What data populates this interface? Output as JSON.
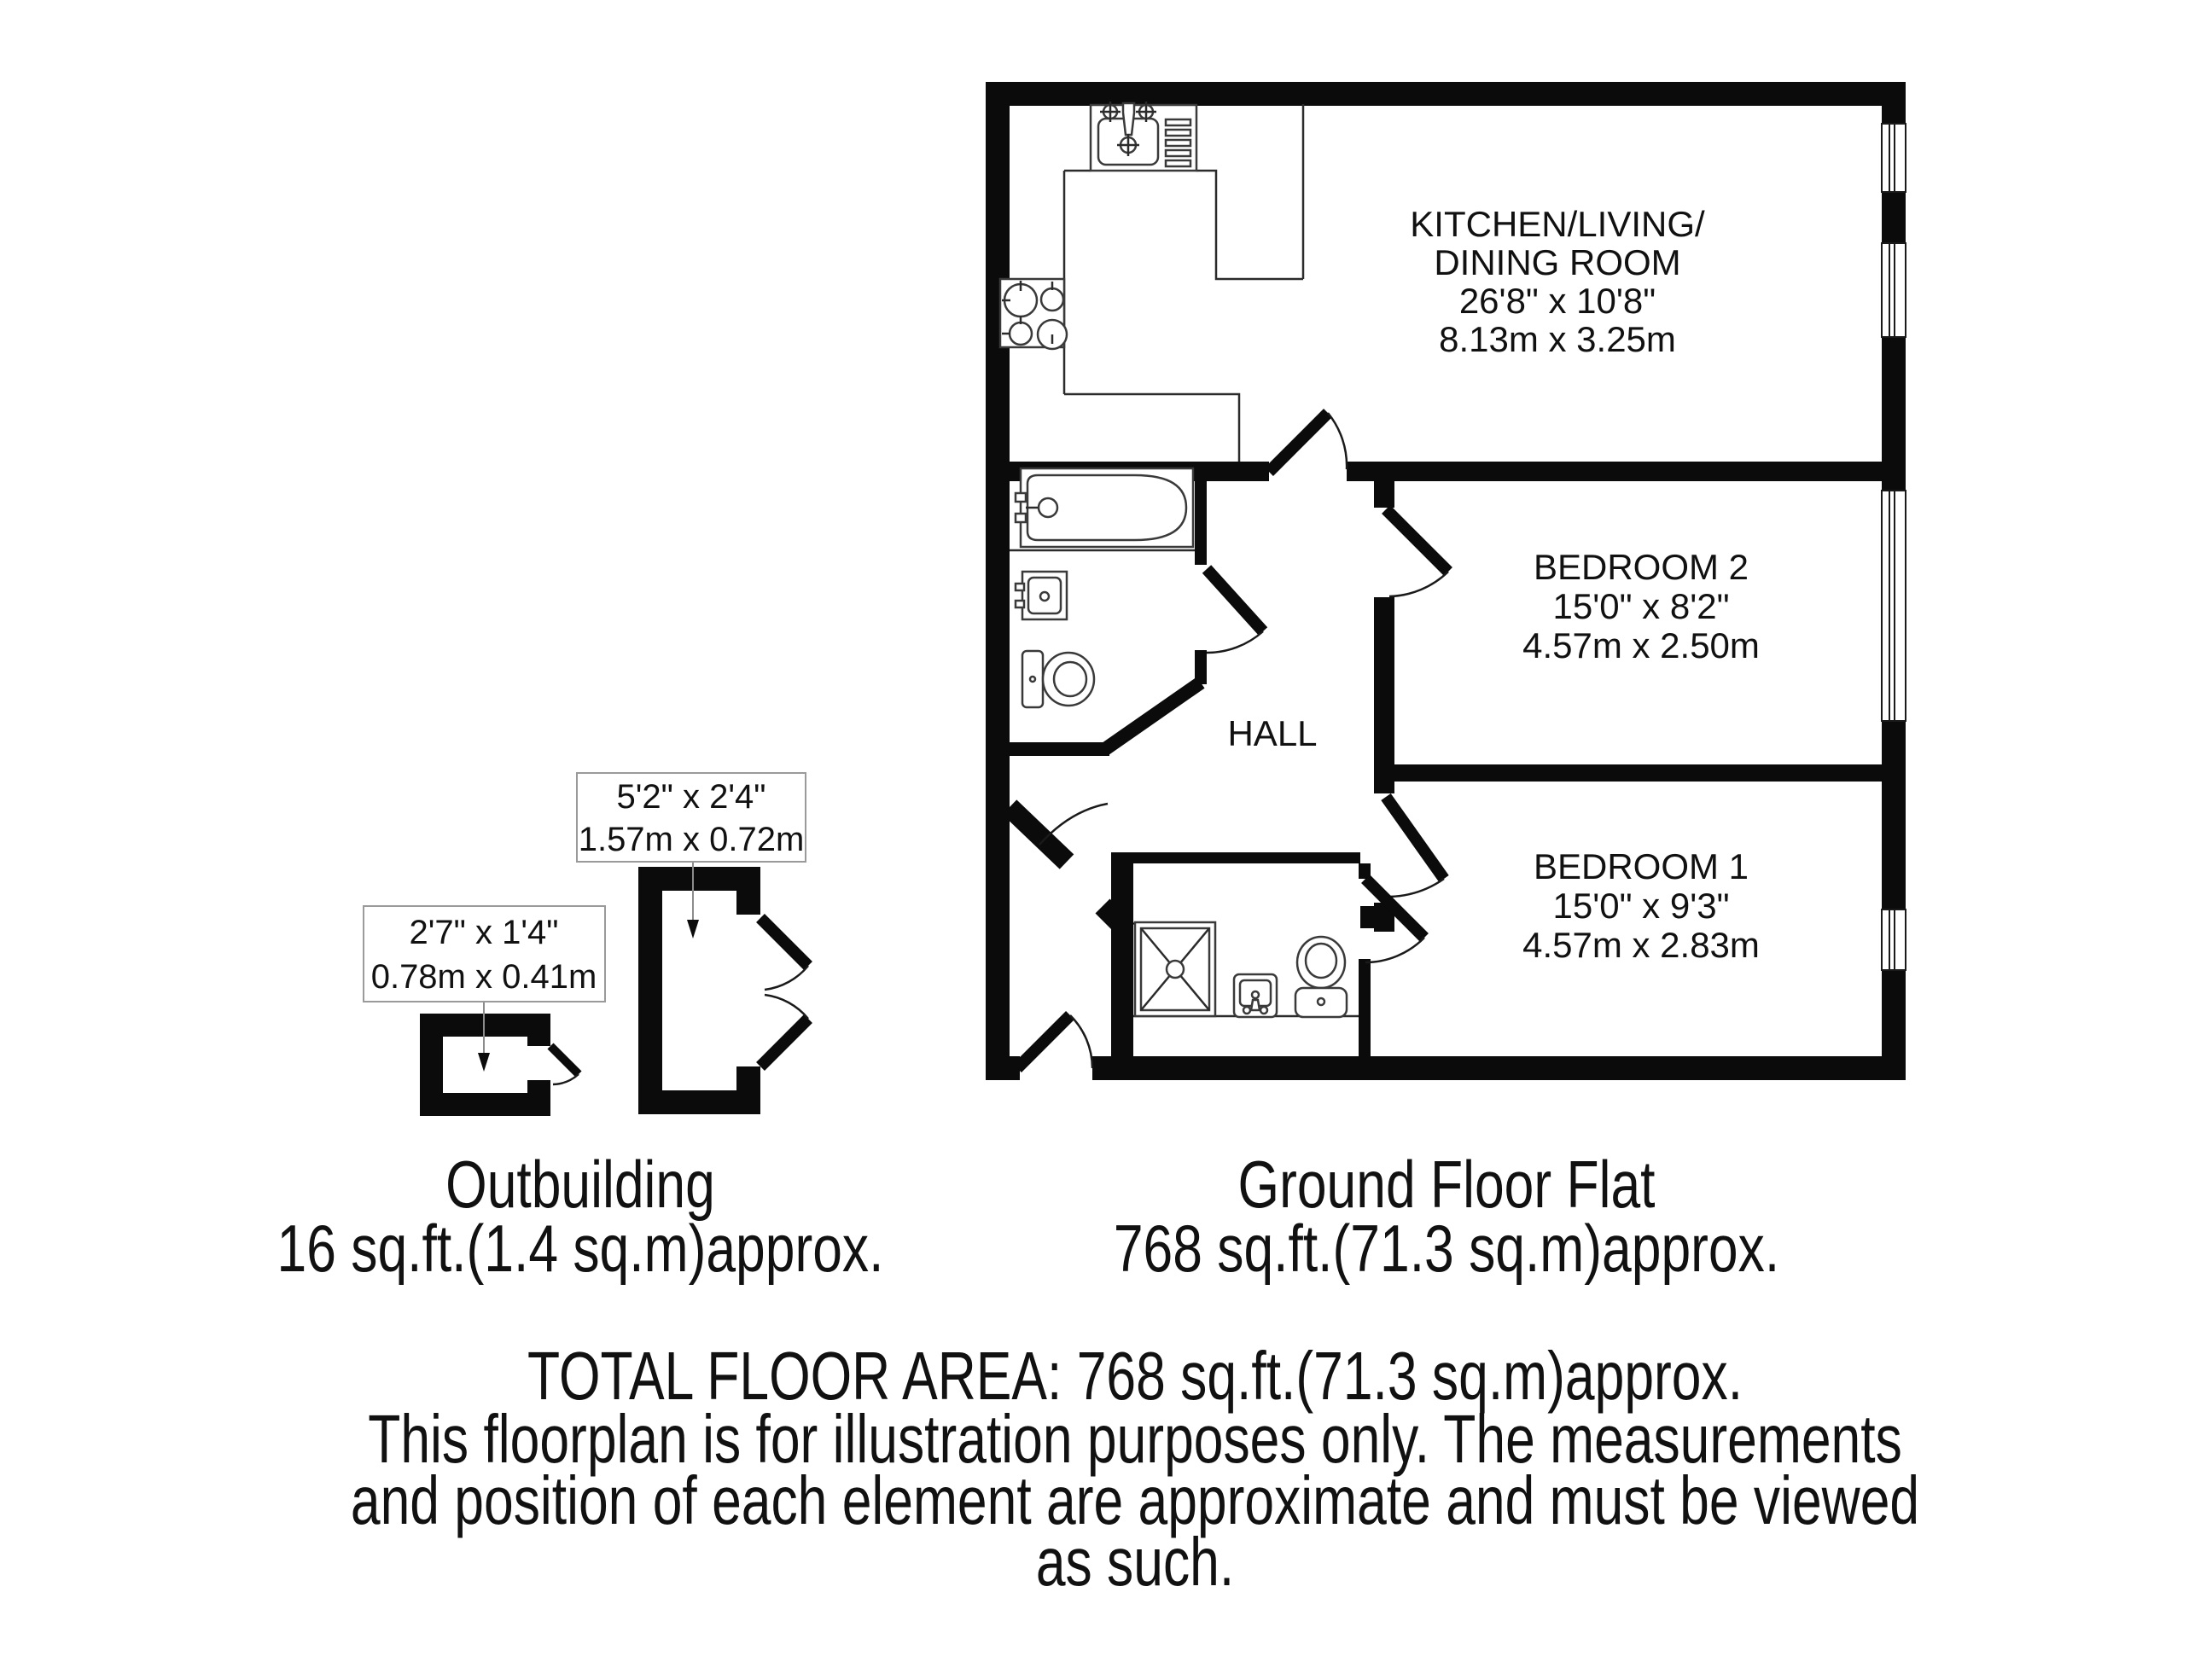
{
  "colors": {
    "wall": "#0b0b0b",
    "fixture_line": "#3a3a3a",
    "label_box_border": "#9a9a9a",
    "leader_line": "#8c8c8c",
    "background": "#ffffff"
  },
  "plan": {
    "flat": {
      "rooms": {
        "kitchen": {
          "label_line1": "KITCHEN/LIVING/",
          "label_line2": "DINING ROOM",
          "dim_imperial": "26'8\" x 10'8\"",
          "dim_metric": "8.13m x 3.25m"
        },
        "bedroom2": {
          "label": "BEDROOM 2",
          "dim_imperial": "15'0\" x 8'2\"",
          "dim_metric": "4.57m x 2.50m"
        },
        "bedroom1": {
          "label": "BEDROOM 1",
          "dim_imperial": "15'0\" x 9'3\"",
          "dim_metric": "4.57m x 2.83m"
        },
        "hall": {
          "label": "HALL"
        }
      }
    },
    "outbuilding": {
      "large_label": {
        "dim_imperial": "5'2\" x 2'4\"",
        "dim_metric": "1.57m x 0.72m"
      },
      "small_label": {
        "dim_imperial": "2'7\" x 1'4\"",
        "dim_metric": "0.78m x 0.41m"
      }
    }
  },
  "captions": {
    "outbuilding": {
      "title": "Outbuilding",
      "area": "16 sq.ft.(1.4 sq.m)approx."
    },
    "flat": {
      "title": "Ground Floor Flat",
      "area": "768 sq.ft.(71.3 sq.m)approx."
    }
  },
  "footer": {
    "total": "TOTAL FLOOR AREA: 768 sq.ft.(71.3 sq.m)approx.",
    "disclaimer_lines": [
      "This floorplan is for illustration purposes only. The measurements",
      "and position of each element are approximate and must be viewed",
      "as such."
    ]
  }
}
